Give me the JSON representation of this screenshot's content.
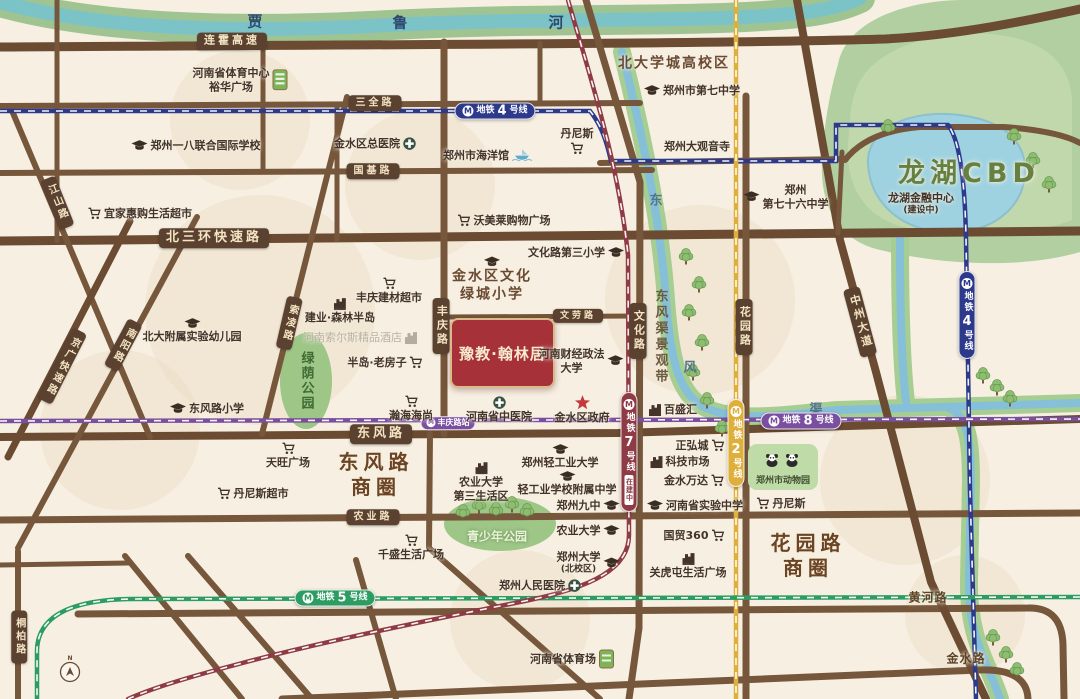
{
  "map": {
    "width": 1080,
    "height": 699,
    "property": {
      "x": 450,
      "y": 318,
      "w": 101,
      "h": 66,
      "label": "豫教·翰林居"
    },
    "colors": {
      "bg": "#F7F0E2",
      "blob": "#ECDEC5",
      "road": "#76573B",
      "road_dark": "#6B4B31",
      "river": "#7CC3C7",
      "river_bank": "#9FC491",
      "canal": "#86BFD8",
      "canal_bank": "#A6CD92",
      "lake": "#9ED2E0",
      "lake_edge": "#8CC0CF",
      "green": "#B2CFA1",
      "green_light": "#C5DBB2",
      "park": "#9DC687",
      "zoo": "#BFDBA8",
      "m2": "#DFAF3C",
      "m4": "#2D3A8C",
      "m5": "#2D9C62",
      "m7": "#8E3B45",
      "m8": "#7B4FA0",
      "star": "#C23A3C"
    },
    "blobs": [
      [
        260,
        310,
        115
      ],
      [
        700,
        300,
        95
      ],
      [
        420,
        185,
        75
      ],
      [
        905,
        480,
        85
      ],
      [
        520,
        620,
        70
      ],
      [
        120,
        430,
        80
      ],
      [
        965,
        615,
        60
      ],
      [
        240,
        120,
        70
      ]
    ],
    "green": {
      "outer": "M838,64 C846,24 898,2 958,0 L1080,0 L1080,252 C1018,270 938,264 880,250 C838,240 820,206 822,162 C824,122 830,92 838,64 Z",
      "inner": "M856,90 C870,50 930,30 990,34 C1040,38 1070,60 1072,100 L1072,220 C1020,240 950,240 900,226 C860,214 846,180 848,146 C850,120 850,104 856,90 Z"
    },
    "lake": {
      "d": "M868,164 C866,130 906,112 948,114 C1000,117 1027,139 1025,174 C1023,210 988,236 941,232 C897,228 870,200 868,164 Z"
    },
    "river": {
      "d": "M-20,-4 C70,26 210,34 370,26 C560,16 690,24 800,13 C830,9 845,5 860,-2"
    },
    "canals": [
      "M622,52 C646,150 661,228 666,300 C670,356 678,392 702,406 C734,424 790,414 838,410 L1080,403",
      "M900,238 C900,300 901,360 906,402",
      "M946,407 C968,413 971,442 971,482 L969,580 C968,640 988,662 1000,699"
    ],
    "parks": {
      "luyin": {
        "cx": 306,
        "cy": 381,
        "rx": 26,
        "ry": 48
      },
      "youth": {
        "cx": 500,
        "cy": 524,
        "rx": 56,
        "ry": 27
      }
    },
    "zoo": {
      "x": 748,
      "y": 444,
      "w": 70,
      "h": 46,
      "label": "郑州市动物园"
    },
    "roads": [
      {
        "d": "M0,47 C300,45 720,44 885,39 C960,35 1030,20 1080,9",
        "w": 9,
        "dark": true
      },
      {
        "d": "M0,106 L640,103",
        "w": 6
      },
      {
        "d": "M0,173 L652,170",
        "w": 6
      },
      {
        "d": "M0,241 L1080,231",
        "w": 9,
        "dark": true
      },
      {
        "d": "M448,317 L642,316",
        "w": 5
      },
      {
        "d": "M0,437 L618,433 L1080,419",
        "w": 8,
        "dark": true
      },
      {
        "d": "M0,520 L1080,513",
        "w": 7
      },
      {
        "d": "M78,614 L1028,608 Q1062,607 1063,645 L1064,699",
        "w": 7
      },
      {
        "d": "M282,699 Q700,683 978,670 Q1027,668 1028,699",
        "w": 7
      },
      {
        "d": "M444,42 L444,434",
        "w": 7
      },
      {
        "d": "M430,434 L429,548 L600,699",
        "w": 6
      },
      {
        "d": "M586,0 L640,182 L639,628 L629,699",
        "w": 7
      },
      {
        "d": "M746,96 L746,699",
        "w": 7
      },
      {
        "d": "M797,0 L840,240 L876,372 L931,582 L986,699",
        "w": 8,
        "dark": true
      },
      {
        "d": "M10,106 L150,437",
        "w": 6
      },
      {
        "d": "M197,217 L18,548",
        "w": 6
      },
      {
        "d": "M130,221 L8,457",
        "w": 7,
        "dark": true
      },
      {
        "d": "M347,97 L262,434",
        "w": 6
      },
      {
        "d": "M18,551 L18,699",
        "w": 6
      },
      {
        "d": "M57,0 L57,241",
        "w": 5
      },
      {
        "d": "M263,46 L263,172",
        "w": 5
      },
      {
        "d": "M337,104 L337,240",
        "w": 5
      },
      {
        "d": "M540,43 L540,104",
        "w": 5
      },
      {
        "d": "M600,163 L846,159",
        "w": 6
      },
      {
        "d": "M845,160 Q868,131 920,127 L1004,127 Q1058,131 1080,143",
        "w": 6
      },
      {
        "d": "M842,152 L838,233",
        "w": 5
      },
      {
        "d": "M125,556 L242,699",
        "w": 6
      },
      {
        "d": "M188,556 L312,699",
        "w": 6
      },
      {
        "d": "M356,560 L396,699",
        "w": 6
      },
      {
        "d": "M0,565 L130,563",
        "w": 5
      }
    ],
    "metro": {
      "m4": {
        "name": "地铁4号线",
        "d": "M0,111 L590,111 C602,126 607,143 611,161 L836,161 L836,125 L948,125 C960,140 965,185 966,238 L970,490 L976,699"
      },
      "m8": {
        "name": "地铁8号线",
        "d": "M0,421 L1080,419"
      },
      "m2": {
        "name": "地铁2号线",
        "d": "M736,0 L736,699"
      },
      "m5": {
        "name": "地铁5号线",
        "d": "M1080,597 L130,599 C75,600 38,614 37,650 L37,699"
      },
      "m7": {
        "name": "地铁7号线",
        "d": "M568,0 C588,70 618,160 628,255 L629,535 C629,568 594,587 525,601 C430,620 320,642 235,665 C185,678 150,689 128,699"
      }
    },
    "metro_badges": [
      {
        "line": "m4",
        "x": 495,
        "y": 111,
        "o": "h",
        "pre": "地铁",
        "num": "4",
        "post": "号线"
      },
      {
        "line": "m4",
        "x": 967,
        "y": 315,
        "o": "v",
        "pre": "地铁",
        "num": "4",
        "post": "号线"
      },
      {
        "line": "m2",
        "x": 736,
        "y": 443,
        "o": "v",
        "pre": "地铁",
        "num": "2",
        "post": "号线"
      },
      {
        "line": "m8",
        "x": 801,
        "y": 421,
        "o": "h",
        "pre": "地铁",
        "num": "8",
        "post": "号线"
      },
      {
        "line": "m5",
        "x": 335,
        "y": 598,
        "o": "h",
        "pre": "地铁",
        "num": "5",
        "post": "号线"
      },
      {
        "line": "m7",
        "x": 629,
        "y": 452,
        "o": "v",
        "pre": "地铁",
        "num": "7",
        "post": "号线",
        "sub": "在建中"
      }
    ],
    "station_badge": {
      "x": 448,
      "y": 423,
      "label": "丰庆路站",
      "line": "m8"
    },
    "road_labels": [
      {
        "t": "连霍高速",
        "x": 232,
        "y": 41,
        "fs": 11
      },
      {
        "t": "三全路",
        "x": 375,
        "y": 103,
        "fs": 10
      },
      {
        "t": "国基路",
        "x": 373,
        "y": 171,
        "fs": 10
      },
      {
        "t": "北三环快速路",
        "x": 214,
        "y": 238,
        "fs": 13
      },
      {
        "t": "文劳路",
        "x": 578,
        "y": 316,
        "fs": 9
      },
      {
        "t": "东风路",
        "x": 381,
        "y": 434,
        "fs": 13
      },
      {
        "t": "农业路",
        "x": 373,
        "y": 517,
        "fs": 10
      },
      {
        "t": "丰庆路",
        "x": 441,
        "y": 326,
        "vert": true,
        "fs": 11
      },
      {
        "t": "文化路",
        "x": 638,
        "y": 331,
        "vert": true,
        "fs": 11
      },
      {
        "t": "花园路",
        "x": 744,
        "y": 327,
        "vert": true,
        "fs": 11
      },
      {
        "t": "中州大道",
        "x": 860,
        "y": 322,
        "vert": true,
        "fs": 11,
        "rot": -15
      },
      {
        "t": "江山路",
        "x": 57,
        "y": 203,
        "vert": true,
        "fs": 10,
        "rot": -22
      },
      {
        "t": "南阳路",
        "x": 123,
        "y": 345,
        "vert": true,
        "fs": 10,
        "rot": 28
      },
      {
        "t": "京广快速路",
        "x": 62,
        "y": 366,
        "vert": true,
        "fs": 10,
        "rot": 27
      },
      {
        "t": "索凌路",
        "x": 289,
        "y": 323,
        "vert": true,
        "fs": 10,
        "rot": 13
      },
      {
        "t": "桐柏路",
        "x": 19,
        "y": 637,
        "vert": true,
        "fs": 10
      }
    ],
    "pois": [
      {
        "name": "henan-sports-center",
        "x": 240,
        "y": 80,
        "lines": [
          "河南省体育中心",
          "裕华广场"
        ],
        "icon": "building-green",
        "side": "right"
      },
      {
        "name": "zhengzhou-18-intl-school",
        "x": 196,
        "y": 146,
        "lines": [
          "郑州一八联合国际学校"
        ],
        "icon": "cap",
        "side": "left"
      },
      {
        "name": "jinshui-district-hospital",
        "x": 375,
        "y": 144,
        "lines": [
          "金水区总医院"
        ],
        "icon": "cross",
        "side": "right"
      },
      {
        "name": "zhengzhou-aquarium",
        "x": 488,
        "y": 156,
        "lines": [
          "郑州市海洋馆"
        ],
        "icon": "ship",
        "side": "right"
      },
      {
        "name": "dennis-north",
        "x": 577,
        "y": 141,
        "lines": [
          "丹尼斯"
        ],
        "icon": "cart",
        "side": "below"
      },
      {
        "name": "beidaxuecheng-area",
        "x": 674,
        "y": 64,
        "lines": [
          "北大学城高校区"
        ],
        "cls": "area-sm"
      },
      {
        "name": "no7-middle-school",
        "x": 692,
        "y": 91,
        "lines": [
          "郑州市第七中学"
        ],
        "icon": "cap",
        "side": "left"
      },
      {
        "name": "guanyin-temple",
        "x": 697,
        "y": 147,
        "lines": [
          "郑州大观音寺"
        ]
      },
      {
        "name": "no76-middle-school",
        "x": 786,
        "y": 197,
        "lines": [
          "郑州",
          "第七十六中学"
        ],
        "icon": "cap",
        "side": "left"
      },
      {
        "name": "longhu-financial-center",
        "x": 921,
        "y": 204,
        "lines": [
          "龙湖金融中心",
          "(建设中)"
        ]
      },
      {
        "name": "longhu-cbd",
        "x": 969,
        "y": 174,
        "lines": [
          "龙湖CBD"
        ],
        "cls": "cbd"
      },
      {
        "name": "ikea-huigou-market",
        "x": 140,
        "y": 214,
        "lines": [
          "宜家惠购生活超市"
        ],
        "icon": "cart",
        "side": "left"
      },
      {
        "name": "fengqing-building-market",
        "x": 389,
        "y": 291,
        "lines": [
          "丰庆建材超市"
        ],
        "icon": "cart",
        "side": "above"
      },
      {
        "name": "jianye-forest-peninsula",
        "x": 340,
        "y": 311,
        "lines": [
          "建业·森林半岛"
        ],
        "icon": "building",
        "side": "above"
      },
      {
        "name": "pku-affiliated-kindergarten",
        "x": 192,
        "y": 331,
        "lines": [
          "北大附属实验幼儿园"
        ],
        "icon": "cap",
        "side": "above"
      },
      {
        "name": "dongfenglu-primary-school",
        "x": 207,
        "y": 409,
        "lines": [
          "东风路小学"
        ],
        "icon": "cap",
        "side": "left"
      },
      {
        "name": "peninsula-old-house",
        "x": 385,
        "y": 363,
        "lines": [
          "半岛·老房子"
        ],
        "icon": "cart",
        "side": "right"
      },
      {
        "name": "hanhai-haishang",
        "x": 411,
        "y": 409,
        "lines": [
          "瀚海海尚"
        ],
        "icon": "cart",
        "side": "above"
      },
      {
        "name": "henan-tcm-hospital",
        "x": 499,
        "y": 410,
        "lines": [
          "河南省中医院"
        ],
        "icon": "cross",
        "side": "above"
      },
      {
        "name": "jinshui-government",
        "x": 582,
        "y": 410,
        "lines": [
          "金水区政府"
        ],
        "icon": "star",
        "side": "above"
      },
      {
        "name": "finance-law-university",
        "x": 581,
        "y": 361,
        "lines": [
          "河南财经政法",
          "大学"
        ],
        "icon": "cap",
        "side": "right"
      },
      {
        "name": "lvcheng-primary-school",
        "x": 492,
        "y": 280,
        "lines": [
          "金水区文化",
          "绿城小学"
        ],
        "icon": "cap",
        "side": "above",
        "cls": "area-sm"
      },
      {
        "name": "wenhualu-3rd-primary",
        "x": 576,
        "y": 253,
        "lines": [
          "文化路第三小学"
        ],
        "icon": "cap",
        "side": "right"
      },
      {
        "name": "womeilai-mall",
        "x": 504,
        "y": 221,
        "lines": [
          "沃美莱购物广场"
        ],
        "icon": "cart",
        "side": "left"
      },
      {
        "name": "baishenghui",
        "x": 673,
        "y": 410,
        "lines": [
          "百盛汇"
        ],
        "icon": "building",
        "side": "left"
      },
      {
        "name": "zhenghongcheng",
        "x": 700,
        "y": 446,
        "lines": [
          "正弘城"
        ],
        "icon": "cart",
        "side": "right"
      },
      {
        "name": "tech-market",
        "x": 680,
        "y": 462,
        "lines": [
          "科技市场"
        ],
        "icon": "building",
        "side": "left"
      },
      {
        "name": "jinshui-wanda",
        "x": 694,
        "y": 481,
        "lines": [
          "金水万达"
        ],
        "icon": "cart",
        "side": "right"
      },
      {
        "name": "henan-experimental-school",
        "x": 695,
        "y": 506,
        "lines": [
          "河南省实验中学"
        ],
        "icon": "cap",
        "side": "left"
      },
      {
        "name": "guomao-360",
        "x": 694,
        "y": 536,
        "lines": [
          "国贸360"
        ],
        "icon": "cart",
        "side": "right"
      },
      {
        "name": "guanhutun-plaza",
        "x": 688,
        "y": 566,
        "lines": [
          "关虎屯生活广场"
        ],
        "icon": "building",
        "side": "above"
      },
      {
        "name": "dennis-east",
        "x": 781,
        "y": 504,
        "lines": [
          "丹尼斯"
        ],
        "icon": "cart",
        "side": "left"
      },
      {
        "name": "tianwang-plaza",
        "x": 288,
        "y": 456,
        "lines": [
          "天旺广场"
        ],
        "icon": "cart",
        "side": "above"
      },
      {
        "name": "dennis-market",
        "x": 253,
        "y": 494,
        "lines": [
          "丹尼斯超市"
        ],
        "icon": "cart",
        "side": "left"
      },
      {
        "name": "qiansheng-plaza",
        "x": 411,
        "y": 548,
        "lines": [
          "千盛生活广场"
        ],
        "icon": "cart",
        "side": "above"
      },
      {
        "name": "light-industry-university",
        "x": 560,
        "y": 457,
        "lines": [
          "郑州轻工业大学"
        ],
        "icon": "cap",
        "side": "above"
      },
      {
        "name": "agri-univ-3rd-living-area",
        "x": 481,
        "y": 482,
        "lines": [
          "农业大学",
          "第三生活区"
        ],
        "icon": "building",
        "side": "above"
      },
      {
        "name": "light-industry-affiliated-school",
        "x": 567,
        "y": 484,
        "lines": [
          "轻工业学校附属中学"
        ],
        "icon": "cap",
        "side": "above"
      },
      {
        "name": "zhengzhou-9th-middle",
        "x": 588,
        "y": 506,
        "lines": [
          "郑州九中"
        ],
        "icon": "cap",
        "side": "right"
      },
      {
        "name": "agricultural-university",
        "x": 588,
        "y": 531,
        "lines": [
          "农业大学"
        ],
        "icon": "cap",
        "side": "right"
      },
      {
        "name": "zhengzhou-univ-north-campus",
        "x": 588,
        "y": 563,
        "lines": [
          "郑州大学",
          "(北校区)"
        ],
        "icon": "cap",
        "side": "right"
      },
      {
        "name": "people-hospital",
        "x": 540,
        "y": 586,
        "lines": [
          "郑州人民医院"
        ],
        "icon": "cross",
        "side": "right"
      },
      {
        "name": "henan-stadium",
        "x": 572,
        "y": 659,
        "lines": [
          "河南省体育场"
        ],
        "icon": "stadium",
        "side": "right"
      },
      {
        "name": "huanghe-road-name",
        "x": 928,
        "y": 598,
        "lines": [
          "黄河路"
        ],
        "cls": "roadname"
      },
      {
        "name": "jinshui-road-name",
        "x": 966,
        "y": 659,
        "lines": [
          "金水路"
        ],
        "cls": "roadname"
      },
      {
        "name": "dongfeng-road-district",
        "x": 376,
        "y": 475,
        "lines": [
          "东风路",
          "商圈"
        ],
        "cls": "district"
      },
      {
        "name": "huayuan-road-district",
        "x": 808,
        "y": 556,
        "lines": [
          "花园路",
          "商圈"
        ],
        "cls": "district"
      },
      {
        "name": "youth-park-label",
        "x": 497,
        "y": 537,
        "lines": [
          "青少年公园"
        ],
        "cls": "park-label"
      },
      {
        "name": "hotel-watermark",
        "x": 360,
        "y": 338,
        "lines": [
          "河南索尔斯精品酒店"
        ],
        "cls": "watermark",
        "icon": "building-gray",
        "side": "right"
      }
    ],
    "chars": [
      {
        "t": "贾",
        "x": 255,
        "y": 21,
        "cls": "rchar"
      },
      {
        "t": "鲁",
        "x": 400,
        "y": 22,
        "cls": "rchar"
      },
      {
        "t": "河",
        "x": 556,
        "y": 22,
        "cls": "rchar"
      },
      {
        "t": "东",
        "x": 656,
        "y": 199,
        "cls": "cchar"
      },
      {
        "t": "风",
        "x": 690,
        "y": 366,
        "cls": "cchar"
      },
      {
        "t": "渠",
        "x": 816,
        "y": 408,
        "cls": "cchar"
      }
    ],
    "vlabels": [
      {
        "t": "东风渠景观带",
        "x": 660,
        "y": 337,
        "cls": "vcanal",
        "name": "dongfengqu-scenic-belt-label"
      },
      {
        "t": "绿荫公园",
        "x": 306,
        "y": 381,
        "cls": "vpark",
        "name": "lvyin-park-label"
      }
    ],
    "trees": [
      [
        686,
        256
      ],
      [
        699,
        284
      ],
      [
        689,
        312
      ],
      [
        702,
        342
      ],
      [
        693,
        372
      ],
      [
        707,
        400
      ],
      [
        722,
        428
      ],
      [
        736,
        452
      ],
      [
        983,
        375
      ],
      [
        997,
        387
      ],
      [
        1010,
        398
      ],
      [
        993,
        637
      ],
      [
        1006,
        654
      ],
      [
        1017,
        670
      ],
      [
        888,
        127
      ],
      [
        1014,
        136
      ],
      [
        1033,
        160
      ],
      [
        1049,
        184
      ],
      [
        463,
        512
      ],
      [
        479,
        505
      ],
      [
        496,
        510
      ],
      [
        512,
        504
      ],
      [
        527,
        511
      ]
    ],
    "compass": {
      "x": 70,
      "y": 672
    }
  }
}
